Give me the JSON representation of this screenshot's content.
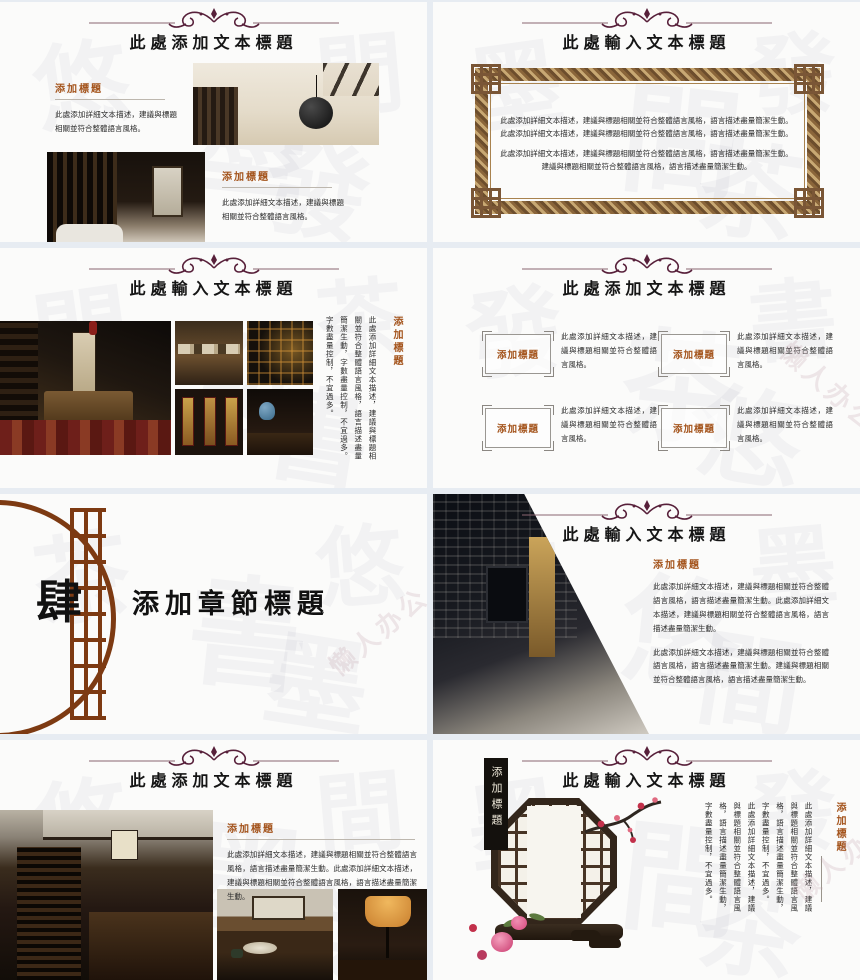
{
  "colors": {
    "accent_brown": "#a4541c",
    "ornament": "#57203a",
    "gold_frame": "#b08d4f",
    "section_brown": "#7d3a12",
    "slide_bg": "#fbfbfa",
    "gap_bg": "#e7ecf2"
  },
  "watermark": {
    "text": "懒人办公"
  },
  "deco": {
    "glyphs": [
      "悠",
      "墨",
      "間",
      "發",
      "茶",
      "書"
    ]
  },
  "slides": [
    {
      "title": "此處添加文本標題",
      "blocks": [
        {
          "heading": "添加標題",
          "body": "此處添加詳細文本描述，建議與標題相關並符合整體語言風格。"
        },
        {
          "heading": "添加標題",
          "body": "此處添加詳細文本描述，建議與標題相關並符合整體語言風格。"
        }
      ]
    },
    {
      "title": "此處輸入文本標題",
      "lines": [
        "此處添加詳細文本描述，建議與標題相關並符合整體語言風格，語言描述盡量簡潔生動。",
        "此處添加詳細文本描述，建議與標題相關並符合整體語言風格，語言描述盡量簡潔生動。",
        "此處添加詳細文本描述，建議與標題相關並符合整體語言風格，語言描述盡量簡潔生動。",
        "建議與標題相關並符合整體語言風格，語言描述盡量簡潔生動。"
      ]
    },
    {
      "title": "此處輸入文本標題",
      "heading": "添加標題",
      "body": "此處添加詳細文本描述，建議與標題相關並符合整體語言風格，語言描述盡量簡潔生動，字數盡量控制，不宜過多。字數盡量控制，不宜過多。"
    },
    {
      "title": "此處添加文本標題",
      "items": [
        {
          "label": "添加標題",
          "body": "此處添加詳細文本描述，建議與標題相關並符合整體語言風格。"
        },
        {
          "label": "添加標題",
          "body": "此處添加詳細文本描述，建議與標題相關並符合整體語言風格。"
        },
        {
          "label": "添加標題",
          "body": "此處添加詳細文本描述，建議與標題相關並符合整體語言風格。"
        },
        {
          "label": "添加標題",
          "body": "此處添加詳細文本描述，建議與標題相關並符合整體語言風格。"
        }
      ]
    },
    {
      "number": "肆",
      "title": "添加章節標題"
    },
    {
      "title": "此處輸入文本標題",
      "heading": "添加標題",
      "para1": "此處添加詳細文本描述，建議與標題相關並符合整體語言風格，語言描述盡量簡潔生動。此處添加詳細文本描述，建議與標題相關並符合整體語言風格，語言描述盡量簡潔生動。",
      "para2": "此處添加詳細文本描述，建議與標題相關並符合整體語言風格，語言描述盡量簡潔生動。建議與標題相關並符合整體語言風格，語言描述盡量簡潔生動。"
    },
    {
      "title": "此處添加文本標題",
      "heading": "添加標題",
      "body": "此處添加詳細文本描述，建議與標題相關並符合整體語言風格，語言描述盡量簡潔生動。此處添加詳細文本描述，建議與標題相關並符合整體語言風格，語言描述盡量簡潔生動。"
    },
    {
      "title": "此處輸入文本標題",
      "window_label": "添加標題",
      "heading": "添加標題",
      "para1": "此處添加詳細文本描述，建議與標題相關並符合整體語言風格，語言描述盡量簡潔生動，字數盡量控制，不宜過多。",
      "para2": "此處添加詳細文本描述，建議與標題相關並符合整體語言風格，語言描述盡量簡潔生動，字數盡量控制，不宜過多。"
    }
  ]
}
